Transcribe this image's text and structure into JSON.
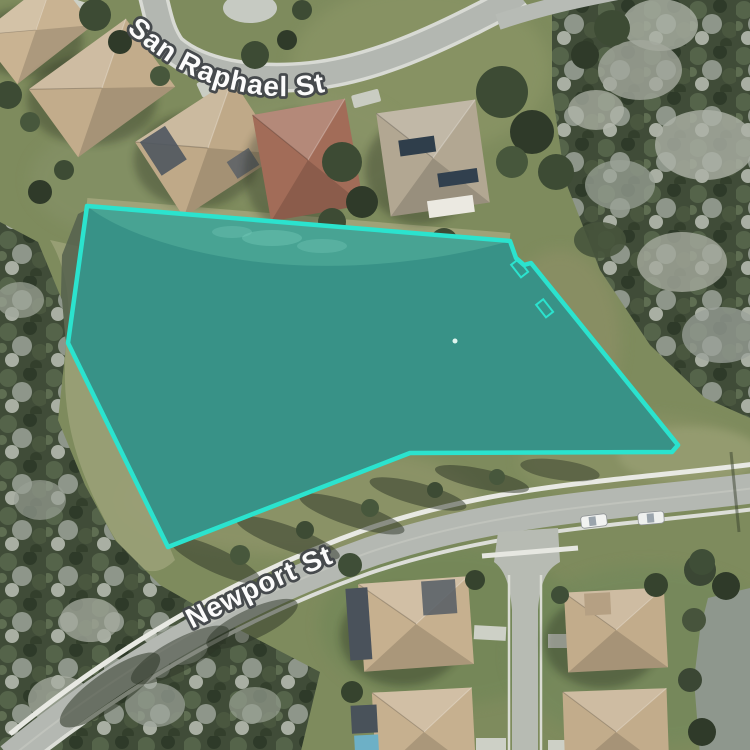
{
  "map": {
    "view_type": "satellite-aerial",
    "street_labels": {
      "san_raphael": "San Raphael St",
      "newport": "Newport St"
    },
    "parcel": {
      "description": "highlighted pond parcel polygon",
      "stroke_color": "#2BE3CE",
      "fill_color": "#389287",
      "vertices": "87,206 510,241 516,258 524,265 531,263 678,445 672,452 410,453 168,547 68,343"
    }
  }
}
